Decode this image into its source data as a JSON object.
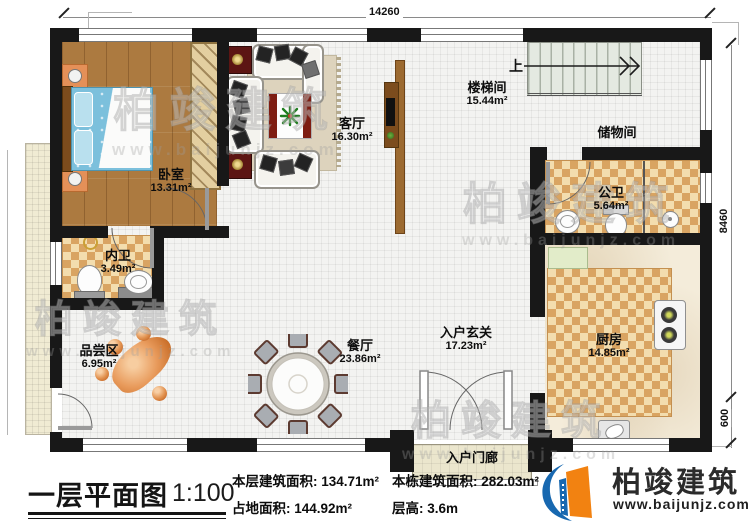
{
  "plan": {
    "dim_top": "14260",
    "dim_right": "8460",
    "dim_right_lower": "600",
    "stairs_up": "上"
  },
  "rooms": {
    "bedroom": {
      "name": "卧室",
      "area": "13.31m²"
    },
    "living_room": {
      "name": "客厅",
      "area": "16.30m²"
    },
    "stair_hall": {
      "name": "楼梯间",
      "area": "15.44m²"
    },
    "storage": {
      "name": "储物间"
    },
    "public_bath": {
      "name": "公卫",
      "area": "5.64m²"
    },
    "private_bath": {
      "name": "内卫",
      "area": "3.49m²"
    },
    "tasting_area": {
      "name": "品尝区",
      "area": "6.95m²"
    },
    "dining_room": {
      "name": "餐厅",
      "area": "23.86m²"
    },
    "entry_foyer": {
      "name": "入户玄关",
      "area": "17.23m²"
    },
    "kitchen": {
      "name": "厨房",
      "area": "14.85m²"
    },
    "entry_porch": {
      "name": "入户门廊"
    }
  },
  "caption": {
    "title": "一层平面图",
    "scale": "1:100",
    "stats": {
      "floor_area_label": "本层建筑面积:",
      "floor_area_value": "134.71m²",
      "land_area_label": "占地面积:",
      "land_area_value": "144.92m²",
      "total_area_label": "本栋建筑面积:",
      "total_area_value": "282.03m²",
      "story_height_label": "层高:",
      "story_height_value": "3.6m"
    }
  },
  "brand": {
    "name": "柏竣建筑",
    "website": "www.baijunjz.com"
  },
  "watermark": {
    "text": "柏竣建筑",
    "url": "www.baijunjz.com"
  },
  "colors": {
    "wall": "#181818",
    "brand_blue": "#1868b0",
    "brand_orange": "#f28211",
    "checker": "#d9a462"
  }
}
